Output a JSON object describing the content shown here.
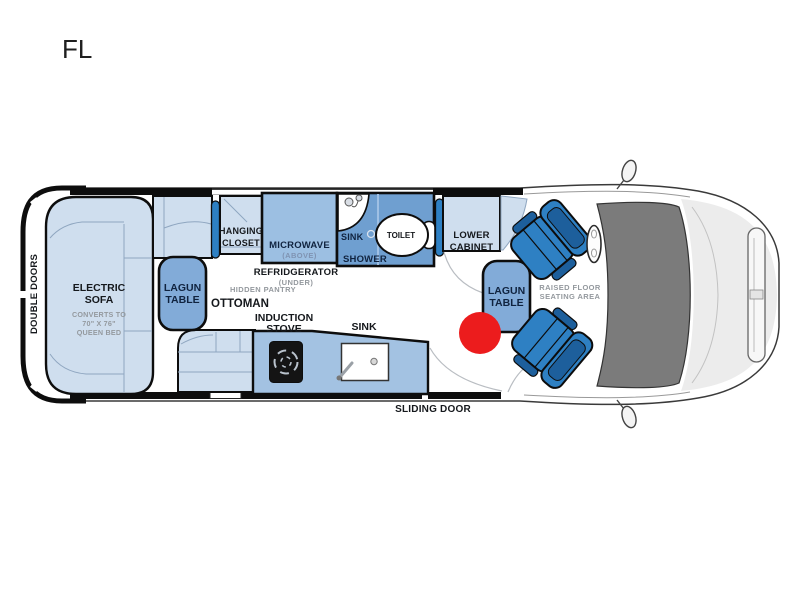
{
  "title": "FL",
  "van": {
    "rear_door_label": "DOUBLE DOORS",
    "sliding_door_label": "SLIDING DOOR",
    "raised_floor_lines": [
      "RAISED FLOOR",
      "SEATING AREA"
    ]
  },
  "furniture": {
    "electric_sofa": {
      "name_lines": [
        "ELECTRIC",
        "SOFA"
      ],
      "note_lines": [
        "CONVERTS TO",
        "70\" X 76\"",
        "QUEEN BED"
      ]
    },
    "lagun_table_rear": {
      "lines": [
        "LAGUN",
        "TABLE"
      ]
    },
    "lagun_table_front": {
      "lines": [
        "LAGUN",
        "TABLE"
      ]
    },
    "ottoman_label": "OTTOMAN",
    "hidden_pantry_label": "HIDDEN PANTRY",
    "hanging_closet_lines": [
      "HANGING",
      "CLOSET"
    ],
    "tv_rear_label": "TV",
    "tv_front_label": "TV",
    "microwave": {
      "name": "MICROWAVE",
      "note": "(ABOVE)"
    },
    "refrigerator": {
      "name": "REFRIDGERATOR",
      "note": "(UNDER)"
    },
    "lower_cabinet_lines": [
      "LOWER",
      "CABINET"
    ],
    "induction_stove_lines": [
      "INDUCTION",
      "STOVE"
    ],
    "kitchen_sink_label": "SINK"
  },
  "bathroom": {
    "sink_label": "SINK",
    "shower_label": "SHOWER",
    "toilet_label": "TOILET"
  },
  "colors": {
    "blue_light": "#cfdeee",
    "blue_mid": "#9cbfe2",
    "blue_counter": "#a3c2e2",
    "blue_table": "#82abd8",
    "blue_bath": "#6f9fd0",
    "blue_seat": "#2e80c3",
    "marker_red": "#ec1c1d"
  }
}
